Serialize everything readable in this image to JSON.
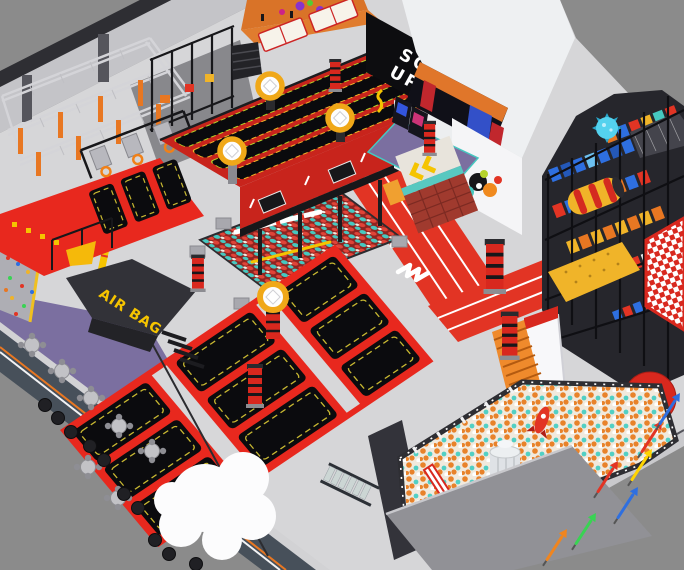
{
  "scene": {
    "type": "3d-render",
    "subject": "indoor trampoline park and soft-play facility, isometric aerial view",
    "labels": {
      "squad_line1": "SQUAD",
      "squad_line2": "UP",
      "air_bag": "AIR BAG"
    },
    "palette": {
      "background": "#8b8b8b",
      "floor": "#d6d6d8",
      "wall_face": "#c4c4c8",
      "wall_cap": "#2e2e33",
      "frame_red": "#e8281e",
      "deep_red": "#c8241c",
      "track_red": "#e23424",
      "mat_black": "#0b0b0e",
      "mat_trim_yellow": "#c8b832",
      "accent_yellow": "#f5c400",
      "ring_yellow": "#f0a818",
      "purple_floor": "#7b6fa0",
      "slate_wall": "#47505a",
      "orange": "#e87722",
      "dodgeball_orange": "#e0762e",
      "teal": "#46c8c0",
      "blue": "#2e6fe0",
      "cream": "#f1e9dd",
      "ball_orange": "#e8822a",
      "cloud_white": "#fcfcfd",
      "building_white": "#eef0f2",
      "squad_black": "#0d0d10",
      "airbag_black": "#323238",
      "lime": "#b6d32a",
      "checker_red": "#d8281e"
    },
    "zones": [
      {
        "id": "ninja-course",
        "label": "Ninja truss course"
      },
      {
        "id": "climbing-wall",
        "label": "Climbing wall"
      },
      {
        "id": "slam-dunk-court",
        "label": "Slam dunk trampolines"
      },
      {
        "id": "dodgeball-court",
        "label": "Dodgeball courts"
      },
      {
        "id": "elevated-trampoline-lanes",
        "label": "Elevated trampoline lanes"
      },
      {
        "id": "squad-up-wall",
        "label": "Squad Up wall"
      },
      {
        "id": "party-stage-building",
        "label": "Stage / party building"
      },
      {
        "id": "running-track",
        "label": "Running track"
      },
      {
        "id": "turnstile-gates",
        "label": "Entry turnstiles"
      },
      {
        "id": "foam-pit",
        "label": "Foam ball pit with balance beam"
      },
      {
        "id": "main-trampoline-grid",
        "label": "Main trampoline court"
      },
      {
        "id": "air-bag-platform",
        "label": "Air bag jump platform"
      },
      {
        "id": "cafe-area",
        "label": "Cafe seating area"
      },
      {
        "id": "cloud-decoration",
        "label": "Cloud decoration"
      },
      {
        "id": "kids-playground",
        "label": "Kids soft-play structure"
      },
      {
        "id": "ball-pit",
        "label": "Large ball pit"
      },
      {
        "id": "rocket-tower",
        "label": "Rocket tower"
      },
      {
        "id": "walkway-arrows",
        "label": "Arrow floor decals"
      },
      {
        "id": "perimeter-walls",
        "label": "Perimeter walls"
      }
    ],
    "counts": {
      "cafe_tables": 7,
      "cafe_ottomans": 10,
      "trampoline_mats": 9,
      "dodgeball_courts": 2,
      "dunk_hoops": 3,
      "ring_hoops": 4,
      "floor_arrow_decals": 7
    }
  }
}
